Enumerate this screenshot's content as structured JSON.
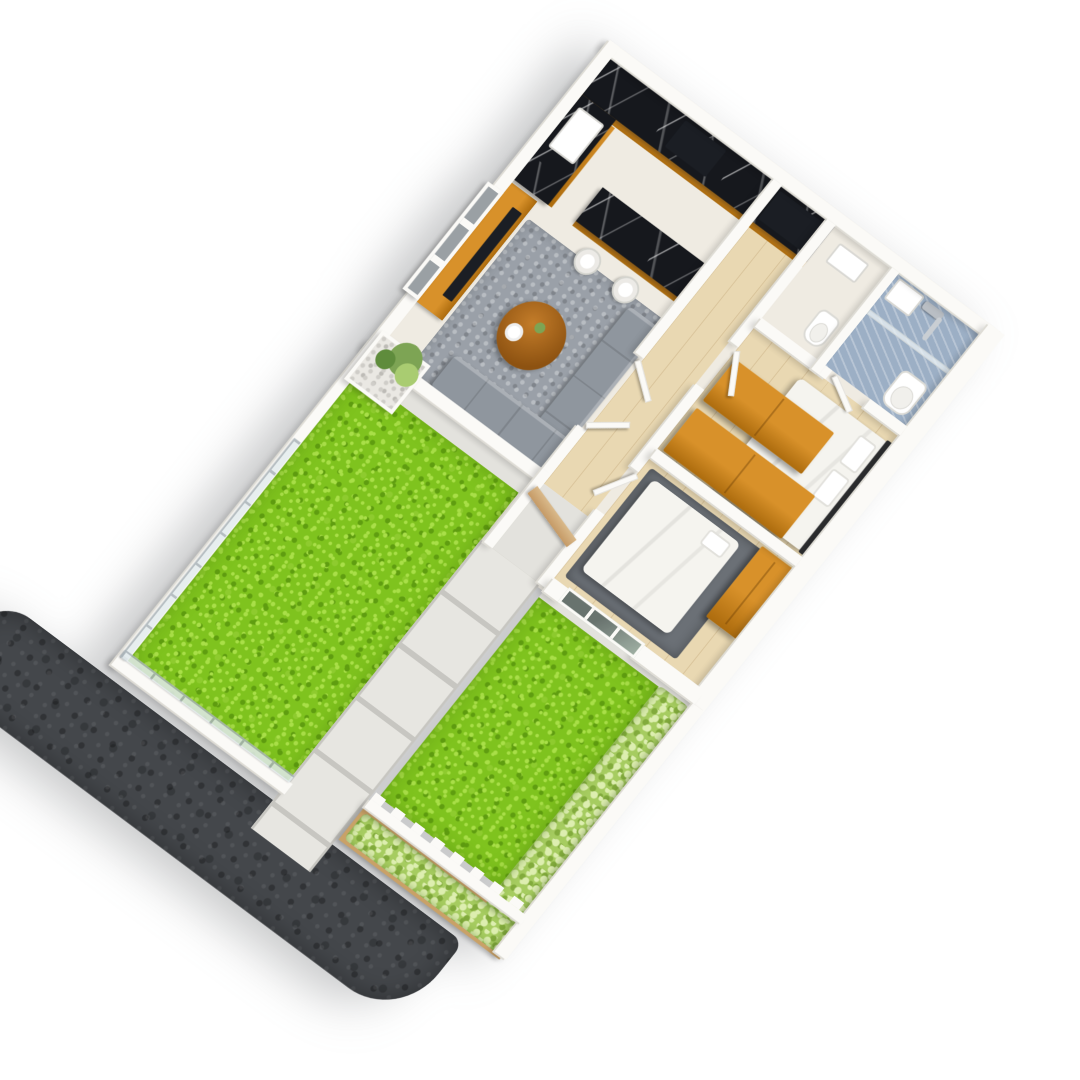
{
  "image_type": "3d-isometric-floor-plan-render",
  "title": "Isometric 3D floor plan of a small house with front garden",
  "palette": {
    "wall": "#fbfaf7",
    "wall-edge": "#dedcd5",
    "floor-pale": "#efebe2",
    "wood-floor": "#e9d8b2",
    "wood": "#d8912a",
    "wood-deep": "#ad6c0e",
    "marble": "#16181d",
    "rug": "#9aa0a8",
    "rug-dark": "#6b7076",
    "sofa": "#8f969e",
    "grass": "#7fc31e",
    "grass-light": "#a9df48",
    "grass-mid": "#8ecb2e",
    "grass-dark": "#5f9d10",
    "hedge": "#a6cc60",
    "hedge-light": "#ddeeb0",
    "hedge-dark": "#82ab3c",
    "pave": "#e7e6e1",
    "pave-gap": "#c7c6c1",
    "concrete": "#e3e2dd",
    "road": "#44474b",
    "tile": "#9cafc5",
    "glass": "#e3ebee",
    "fence-post": "#a8b2b8",
    "planter-wood": "#c9a167",
    "bed": "#f5f4ef",
    "headboard": "#2e2f31",
    "table-wood": "#a8611c",
    "door-wood": "#d9b98a",
    "pebble": "#eae8e3",
    "fixture": "#ffffff",
    "tv": "#1b1e24"
  },
  "scene": {
    "view": "isometric-from-above, plot rotated ~37 degrees",
    "plot": {
      "shape": "rectangle",
      "house_zone": "upper half",
      "garden_zone": "lower half"
    },
    "rooms": [
      {
        "name": "kitchen",
        "features": [
          "black-marble-l-counter",
          "white-sink",
          "dark-cooktop",
          "built-in-oven",
          "island-bar",
          "two-white-bar-stools"
        ]
      },
      {
        "name": "living-room",
        "features": [
          "orange-wood-tv-panel",
          "wall-tv",
          "gray-rug",
          "l-shaped-gray-sofa",
          "round-wood-coffee-table-with-plate-and-plant"
        ]
      },
      {
        "name": "hallway",
        "features": [
          "light-wood-floor",
          "open-white-doors"
        ]
      },
      {
        "name": "toilet-room",
        "features": [
          "washbasin",
          "small-wc"
        ]
      },
      {
        "name": "bathroom",
        "features": [
          "blue-tile-floor",
          "chrome-shower",
          "glass-partition",
          "white-toilet",
          "vanity"
        ]
      },
      {
        "name": "master-bedroom",
        "features": [
          "double-bed-white-duvet",
          "dark-headboard",
          "two-pillows",
          "two-orange-wood-wardrobes"
        ]
      },
      {
        "name": "bedroom-2",
        "features": [
          "bed-with-rumpled-white-duvet",
          "dark-gray-rug",
          "orange-wood-wardrobe",
          "mullioned-window-to-garden"
        ]
      },
      {
        "name": "entry-porch",
        "features": [
          "concrete-floor",
          "wood-entry-door"
        ]
      }
    ],
    "garden": {
      "left-lawn": "long grass strip along left boundary",
      "front-lawn": "large grass area at lower right",
      "walkway": "large concrete pavers from porch to road",
      "hedge-right": "light green shrub row along right boundary",
      "planter-hedge": "wood planter with shrubs outside crenellated front wall",
      "pebble-planter": "white pebble planter with green plant at house corner",
      "window-screen": "white mullioned screen on living room outer wall"
    },
    "exterior": [
      "white-boundary-walls",
      "glass-fence-with-posts",
      "crenellated-low-wall",
      "dark-asphalt-road-strip",
      "soft-ground-shadow"
    ]
  }
}
